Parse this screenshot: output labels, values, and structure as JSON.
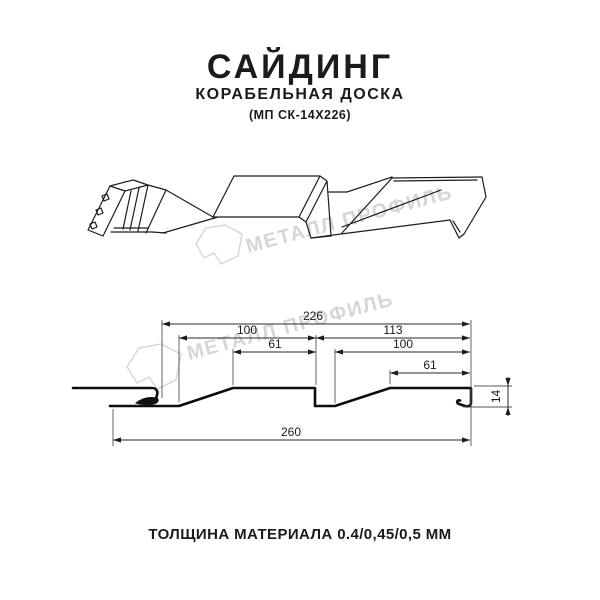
{
  "header": {
    "title": "САЙДИНГ",
    "subtitle": "КОРАБЕЛЬНАЯ ДОСКА",
    "model": "(МП СК-14Х226)"
  },
  "watermark": {
    "brand": "МЕТАЛЛ ПРОФИЛЬ",
    "color": "#d6d6d6"
  },
  "drawing": {
    "dimensions": {
      "coverage": "226",
      "left_pitch": "100",
      "left_crest": "61",
      "right_span": "113",
      "right_pitch": "100",
      "right_crest": "61",
      "overall": "260",
      "height": "14"
    }
  },
  "footer": {
    "thickness": "ТОЛЩИНА МАТЕРИАЛА 0.4/0,45/0,5 ММ"
  }
}
